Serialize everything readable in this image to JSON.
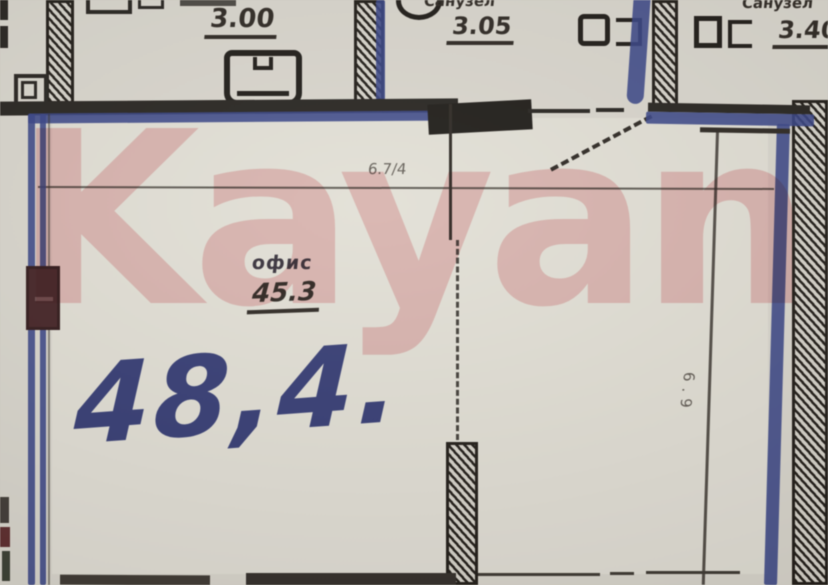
{
  "watermark": {
    "text": "Kayan"
  },
  "plan": {
    "handwritten_area": "48,4.",
    "main_room": {
      "name": "офис",
      "area": "45.3"
    },
    "rooms_top": [
      {
        "name": "",
        "area": "3.00"
      },
      {
        "name": "Санузел",
        "area": "3.05"
      },
      {
        "name": "Санузел",
        "area": "3.40"
      }
    ],
    "dims": {
      "top": "6.7/4",
      "right_vertical": "6.9"
    }
  },
  "colors": {
    "ink_blue": "#2c3b8a",
    "wall_black": "#1d1a17",
    "watermark_pink": "#e4606a",
    "paper": "#dbd8cf",
    "radiator_maroon": "#3f1a1e"
  }
}
